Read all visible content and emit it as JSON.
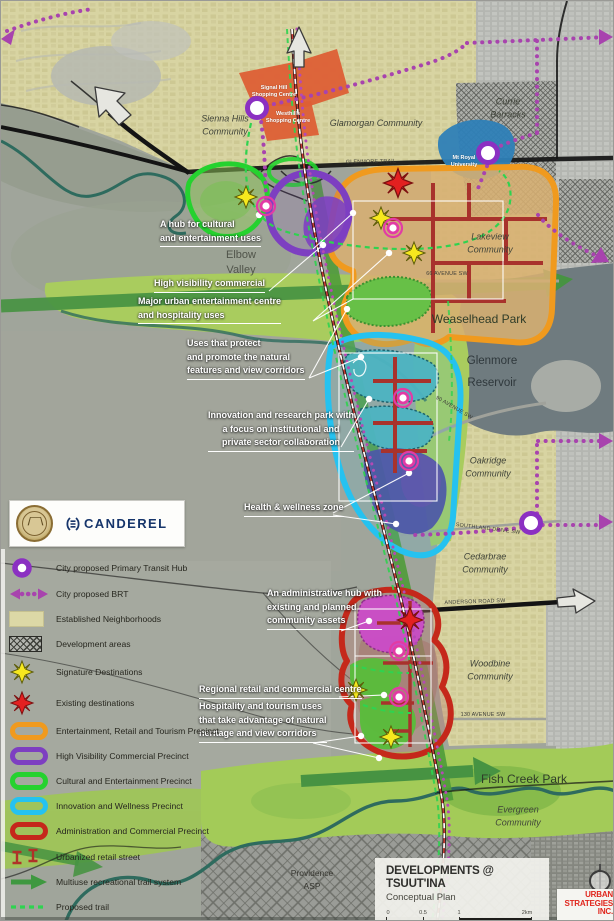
{
  "title_block": {
    "title": "DEVELOPMENTS @ TSUUT'INA",
    "subtitle": "Conceptual Plan",
    "scale_labels": [
      "0",
      "0.5",
      "1",
      "2km"
    ]
  },
  "logos": {
    "canderel": "CANDEREL",
    "urban_strategies": [
      "URBAN",
      "STRATEGIES",
      "INC."
    ]
  },
  "colors": {
    "brt_purple": "#a843ae",
    "transit_hub_purple": "#8b30c2",
    "precinct_orange": "#f09a1e",
    "precinct_purple": "#7d3fc1",
    "precinct_green": "#25d22f",
    "precinct_cyan": "#25c2f0",
    "precinct_red": "#c5281b",
    "signature_yellow": "#f6e81e",
    "existing_red": "#e32020",
    "established_khaki": "#dcd8a6",
    "trail_green": "#3f9840",
    "proposed_trail_green": "#2fd34f",
    "retail_street_red": "#b03228",
    "canderel_navy": "#16356b",
    "urban_strategies_red": "#e0261d"
  },
  "legend": {
    "items": [
      {
        "label": "City proposed Primary Transit Hub",
        "symbol": "transit-hub"
      },
      {
        "label": "City proposed BRT",
        "symbol": "brt"
      },
      {
        "label": "Established Neighborhoods",
        "symbol": "established"
      },
      {
        "label": "Development areas",
        "symbol": "development"
      },
      {
        "label": "Signature Destinations",
        "symbol": "signature"
      },
      {
        "label": "Existing destinations",
        "symbol": "existing"
      },
      {
        "label": "Entertainment, Retail and Tourism Precinct",
        "symbol": "precinct-orange"
      },
      {
        "label": "High Visibility Commercial Precinct",
        "symbol": "precinct-purple"
      },
      {
        "label": "Cultural and Entertainment Precinct",
        "symbol": "precinct-green"
      },
      {
        "label": "Innovation and Wellness Precinct",
        "symbol": "precinct-cyan"
      },
      {
        "label": "Administration and Commercial Precinct",
        "symbol": "precinct-red"
      },
      {
        "label": "Urbanized retail street",
        "symbol": "retail-street"
      },
      {
        "label": "Multiuse recreational trail system",
        "symbol": "trail-arrow"
      },
      {
        "label": "Proposed trail",
        "symbol": "proposed-trail"
      }
    ]
  },
  "map_labels": [
    {
      "lines": [
        "Sienna Hills",
        "Community"
      ],
      "x": 224,
      "y": 124,
      "cls": "community"
    },
    {
      "lines": [
        "Glamorgan Community"
      ],
      "x": 375,
      "y": 122,
      "cls": "community"
    },
    {
      "lines": [
        "Currie",
        "Barracks"
      ],
      "x": 507,
      "y": 107,
      "cls": "community"
    },
    {
      "lines": [
        "Lakeview",
        "Community"
      ],
      "x": 489,
      "y": 242,
      "cls": "community"
    },
    {
      "lines": [
        "Elbow",
        "Valley"
      ],
      "x": 240,
      "y": 262,
      "cls": "area"
    },
    {
      "lines": [
        "Weaselhead Park"
      ],
      "x": 478,
      "y": 318,
      "cls": "park"
    },
    {
      "lines": [
        "Glenmore",
        "Reservoir"
      ],
      "x": 491,
      "y": 371,
      "cls": "water"
    },
    {
      "lines": [
        "Oakridge",
        "Community"
      ],
      "x": 487,
      "y": 466,
      "cls": "community"
    },
    {
      "lines": [
        "Cedarbrae",
        "Community"
      ],
      "x": 484,
      "y": 562,
      "cls": "community"
    },
    {
      "lines": [
        "Woodbine",
        "Community"
      ],
      "x": 489,
      "y": 669,
      "cls": "community"
    },
    {
      "lines": [
        "Fish Creek Park"
      ],
      "x": 523,
      "y": 778,
      "cls": "park"
    },
    {
      "lines": [
        "Evergreen",
        "Community"
      ],
      "x": 517,
      "y": 815,
      "cls": "community"
    },
    {
      "lines": [
        "Providence",
        "ASP"
      ],
      "x": 311,
      "y": 879,
      "cls": "asp"
    },
    {
      "lines": [
        "Signal Hill",
        "Shopping Centre"
      ],
      "x": 273,
      "y": 91,
      "cls": "shop"
    },
    {
      "lines": [
        "Westhills",
        "Shopping Centre"
      ],
      "x": 287,
      "y": 117,
      "cls": "shop"
    },
    {
      "lines": [
        "Mt Royal",
        "University"
      ],
      "x": 463,
      "y": 161,
      "cls": "shop"
    }
  ],
  "road_labels": [
    {
      "text": "GLENMORE TRAIL",
      "x": 370,
      "y": 161,
      "rot": -1
    },
    {
      "text": "66 AVENUE SW",
      "x": 446,
      "y": 273,
      "rot": 0
    },
    {
      "text": "90 AVENUE SW",
      "x": 453,
      "y": 407,
      "rot": 30
    },
    {
      "text": "SOUTHLAND DRIVE SW",
      "x": 487,
      "y": 528,
      "rot": 7
    },
    {
      "text": "ANDERSON ROAD SW",
      "x": 474,
      "y": 601,
      "rot": -2
    },
    {
      "text": "130 AVENUE SW",
      "x": 482,
      "y": 714,
      "rot": 0
    }
  ],
  "annotations": [
    {
      "lines": [
        "A hub for cultural",
        "and entertainment uses"
      ],
      "x": 159,
      "y": 217,
      "underlined": true
    },
    {
      "lines": [
        "High visibility commercial"
      ],
      "x": 153,
      "y": 276,
      "underlined": true
    },
    {
      "lines": [
        "Major urban  entertainment centre",
        "and hospitality uses"
      ],
      "x": 137,
      "y": 294,
      "underlined": true
    },
    {
      "lines": [
        "Uses that protect",
        "and promote the natural",
        "features and view corridors"
      ],
      "x": 186,
      "y": 336,
      "underlined": true
    },
    {
      "lines": [
        "Innovation and research park with",
        "a focus on institutional and",
        "private sector collaboration"
      ],
      "x": 207,
      "y": 408,
      "underlined": true,
      "center": true
    },
    {
      "lines": [
        "Health & wellness zone"
      ],
      "x": 243,
      "y": 500,
      "underlined": true
    },
    {
      "lines": [
        "An administrative hub with",
        "existing and planned",
        "community assets"
      ],
      "x": 266,
      "y": 586,
      "underlined": true
    },
    {
      "lines": [
        "Regional retail and commercial centre"
      ],
      "x": 198,
      "y": 682,
      "underlined": true
    },
    {
      "lines": [
        "Hospitality and tourism uses",
        "that take advantage of natural",
        "heritage and view corridors"
      ],
      "x": 198,
      "y": 699,
      "underlined": true
    }
  ]
}
